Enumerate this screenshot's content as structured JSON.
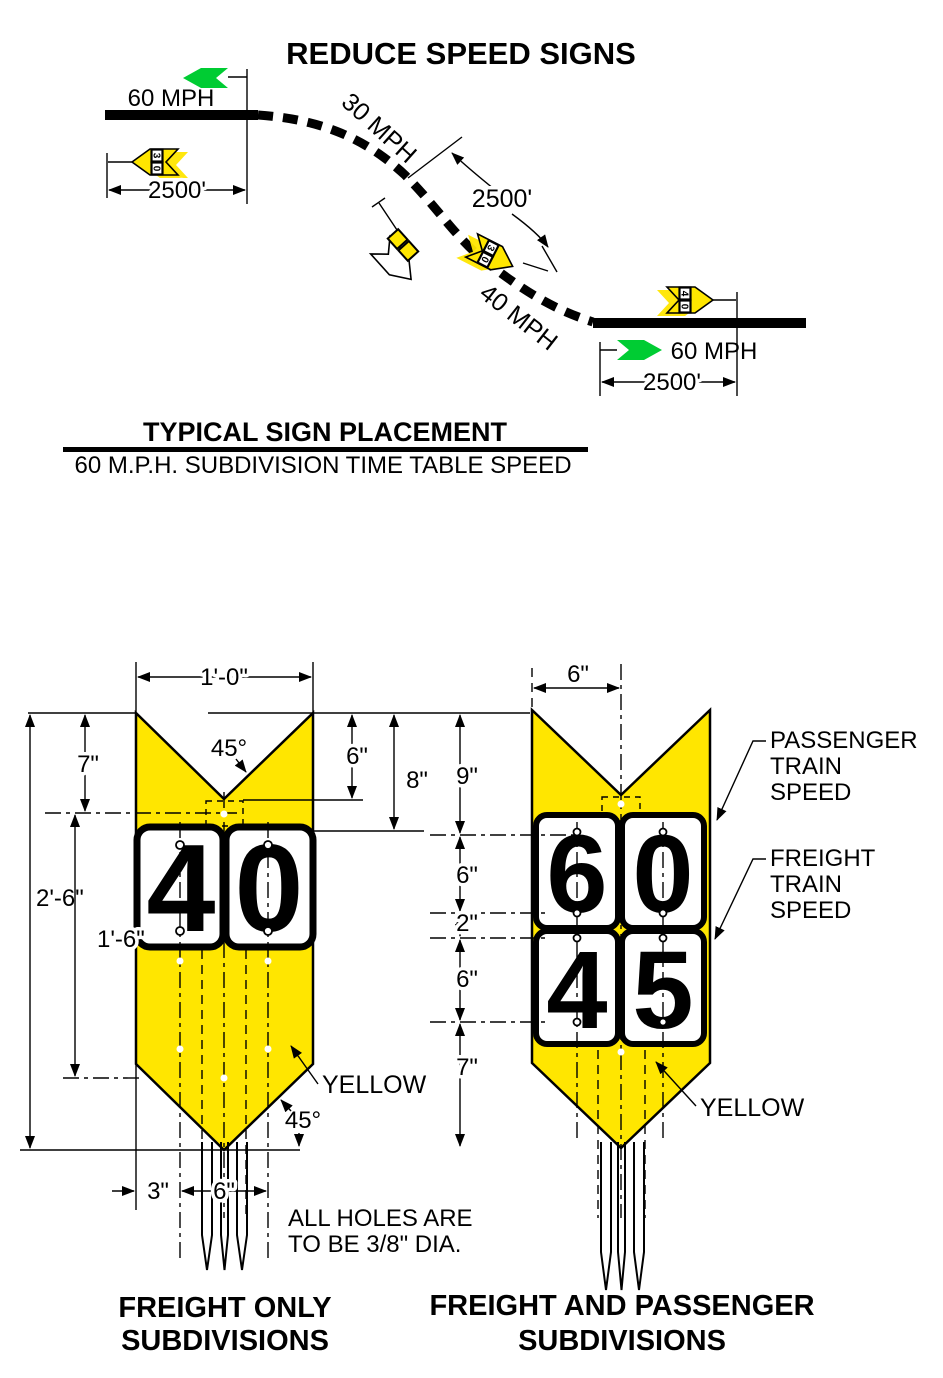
{
  "title": "REDUCE SPEED SIGNS",
  "placement": {
    "heading": "TYPICAL SIGN PLACEMENT",
    "subheading": "60 M.P.H. SUBDIVISION TIME TABLE SPEED",
    "speed_left": "60 MPH",
    "speed_curve_upper": "30 MPH",
    "speed_curve_lower": "40 MPH",
    "speed_right": "60 MPH",
    "distance_left": "2500'",
    "distance_mid": "2500'",
    "distance_right": "2500'",
    "mini_sign_left_digits": [
      "3",
      "0"
    ],
    "mini_sign_curve_digits": [
      "3",
      "0"
    ],
    "mini_sign_right_digits": [
      "4",
      "0"
    ]
  },
  "freight_sign": {
    "caption_line1": "FREIGHT ONLY",
    "caption_line2": "SUBDIVISIONS",
    "digits": [
      "4",
      "0"
    ],
    "dims": {
      "width": "1'-0\"",
      "notch_angle": "45°",
      "top_height": "7\"",
      "notch_depth": "6\"",
      "plaque_top": "8\"",
      "total_height": "2'-6\"",
      "body_height": "1'-6\"",
      "point_angle": "45°",
      "hole_offset": "3\"",
      "hole_spacing": "6\""
    },
    "color_label": "YELLOW"
  },
  "combo_sign": {
    "caption_line1": "FREIGHT AND PASSENGER",
    "caption_line2": "SUBDIVISIONS",
    "digits_top": [
      "6",
      "0"
    ],
    "digits_bottom": [
      "4",
      "5"
    ],
    "dims": {
      "half_width": "6\"",
      "top": "9\"",
      "upper": "6\"",
      "gap": "2\"",
      "lower": "6\"",
      "point": "7\""
    },
    "passenger_label": [
      "PASSENGER",
      "TRAIN",
      "SPEED"
    ],
    "freight_label": [
      "FREIGHT",
      "TRAIN",
      "SPEED"
    ],
    "color_label": "YELLOW"
  },
  "notes": {
    "holes_line1": "ALL HOLES ARE",
    "holes_line2": "TO BE 3/8\" DIA."
  },
  "colors": {
    "sign_yellow": "#FFE600",
    "signal_green": "#00CC33",
    "ink": "#000000"
  }
}
